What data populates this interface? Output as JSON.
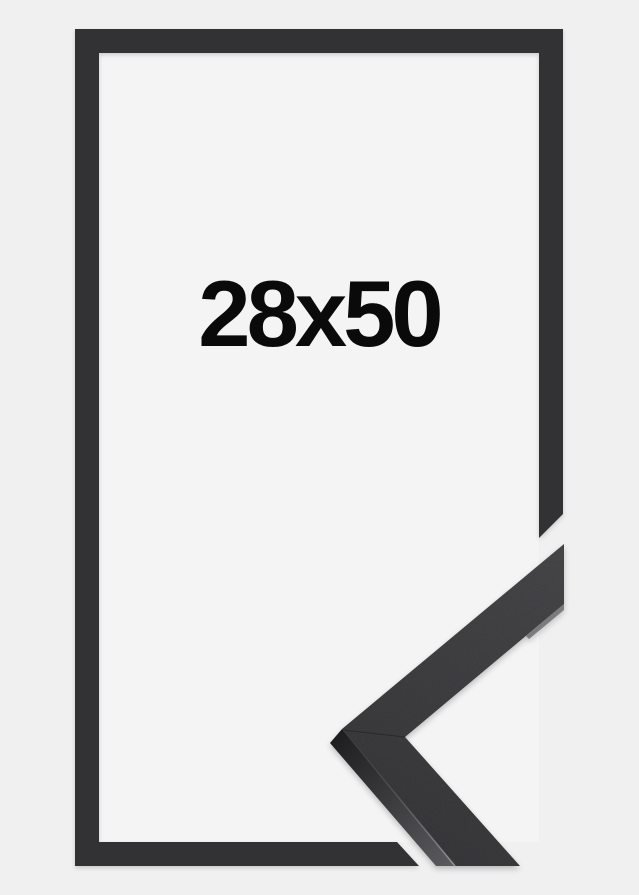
{
  "product": {
    "size_label": "28x50"
  },
  "colors": {
    "background": "#f0f0f1",
    "interior": "#f4f4f5",
    "frame": "#323234",
    "sample_face_light": "#3f3f42",
    "sample_face_dark": "#313134",
    "sample_side_dark": "#1e1e20",
    "sample_side_light": "#5a5a5e",
    "label_text": "#0a0a0a"
  }
}
